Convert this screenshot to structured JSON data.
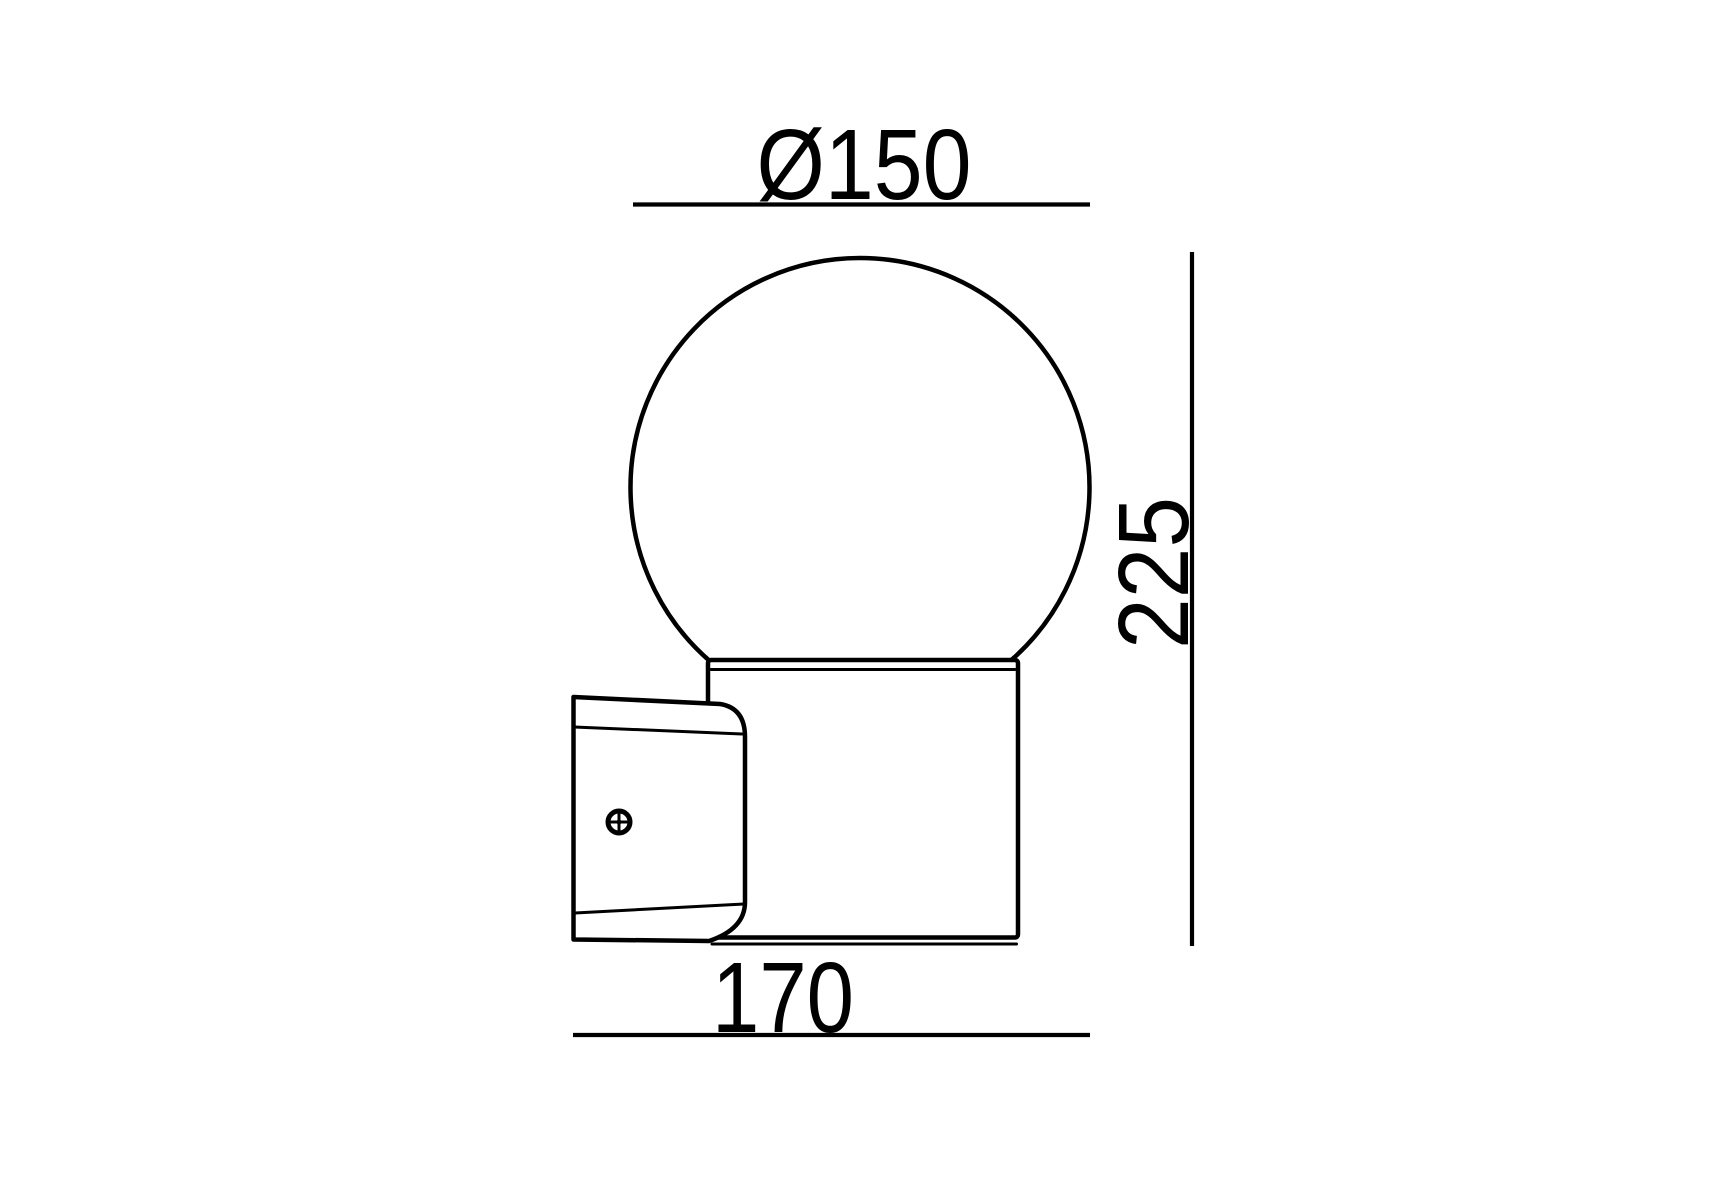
{
  "colors": {
    "background": "#ffffff",
    "line": "#000000"
  },
  "diagram": {
    "kind": "technical dimension drawing, side view of wall-mounted globe light",
    "labels": {
      "diameter": "Ø150",
      "height": "225",
      "depth": "170"
    },
    "values": {
      "diameter": 150,
      "height": 225,
      "depth": 170
    }
  }
}
